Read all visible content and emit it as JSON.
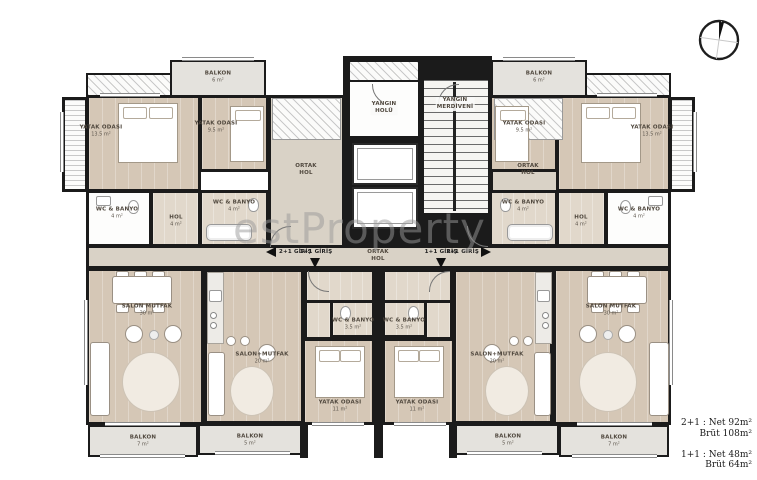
{
  "colors": {
    "wall": "#1b1b1b",
    "wood": "#d5c7b6",
    "wood_light": "#e1d8cb",
    "balcony": "#e4e2dd",
    "hall": "#d9d2c6",
    "watermark": "#9a9a9a"
  },
  "watermark": {
    "text": "estProperty"
  },
  "labels": {
    "bedroom_135": {
      "name": "YATAK ODASI",
      "area": "13.5 m²"
    },
    "bedroom_95": {
      "name": "YATAK ODASI",
      "area": "9.5 m²"
    },
    "bedroom_11": {
      "name": "YATAK ODASI",
      "area": "11 m²"
    },
    "wc_4": {
      "name": "WC & BANYO",
      "area": "4 m²"
    },
    "wc_35": {
      "name": "WC & BANYO",
      "area": "3.5 m²"
    },
    "hol_4": {
      "name": "HOL",
      "area": "4 m²"
    },
    "salon_30": {
      "name": "SALON MUTFAK",
      "area": "30 m²"
    },
    "salon_20": {
      "name": "SALON+MUTFAK",
      "area": "20 m²"
    },
    "balkon_6": {
      "name": "BALKON",
      "area": "6 m²"
    },
    "balkon_7": {
      "name": "BALKON",
      "area": "7 m²"
    },
    "balkon_5": {
      "name": "BALKON",
      "area": "5 m²"
    },
    "yangin_holu": {
      "line1": "YANGIN",
      "line2": "HOLÜ"
    },
    "yangin_merdiveni": {
      "line1": "YANGIN",
      "line2": "MERDİVENİ"
    },
    "ortak_hol": {
      "line1": "ORTAK",
      "line2": "HOL"
    }
  },
  "entries": {
    "e21": "2+1 GİRİŞ",
    "e11": "1+1 GİRİŞ"
  },
  "legend": {
    "l1a": "2+1 : Net 92m²",
    "l1b": "Brüt 108m²",
    "l2a": "1+1 : Net 48m²",
    "l2b": "Brüt 64m²"
  }
}
